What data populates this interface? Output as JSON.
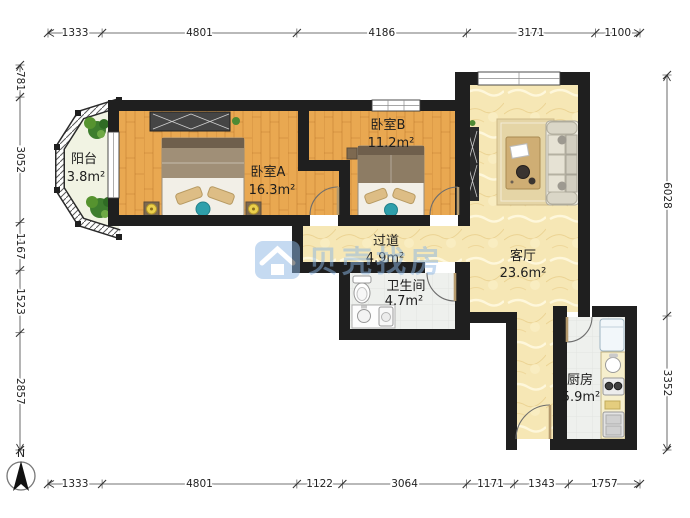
{
  "plan": {
    "type": "floor-plan",
    "rooms": [
      {
        "id": "balcony",
        "name": "阳台",
        "area": "3.8m²"
      },
      {
        "id": "bedroom-a",
        "name": "卧室A",
        "area": "16.3m²"
      },
      {
        "id": "bedroom-b",
        "name": "卧室B",
        "area": "11.2m²"
      },
      {
        "id": "hallway",
        "name": "过道",
        "area": "4.9m²"
      },
      {
        "id": "bathroom",
        "name": "卫生间",
        "area": "4.7m²"
      },
      {
        "id": "living-room",
        "name": "客厅",
        "area": "23.6m²"
      },
      {
        "id": "kitchen",
        "name": "厨房",
        "area": "5.9m²"
      }
    ]
  },
  "dimensions_mm": {
    "top": [
      1333,
      4801,
      4186,
      3171,
      1100
    ],
    "bottom": [
      1333,
      4801,
      1122,
      3064,
      1171,
      1343,
      1757
    ],
    "left": [
      781,
      3052,
      1167,
      1523,
      2857
    ],
    "right": [
      6028,
      3352
    ]
  },
  "compass": {
    "label": "N"
  },
  "watermark": {
    "text": "贝壳找房",
    "logo": "beike-house-logo",
    "color": "#8cb6e4"
  },
  "colors": {
    "wall": "#1f1f1f",
    "wood_floor": "#e9a851",
    "living_floor": "#f6e7b5",
    "tile_floor": "#eef0ed",
    "balcony_floor": "#f1f3e3",
    "accent_teal": "#2f9fab",
    "watermark_blue": "#8cb6e4"
  }
}
